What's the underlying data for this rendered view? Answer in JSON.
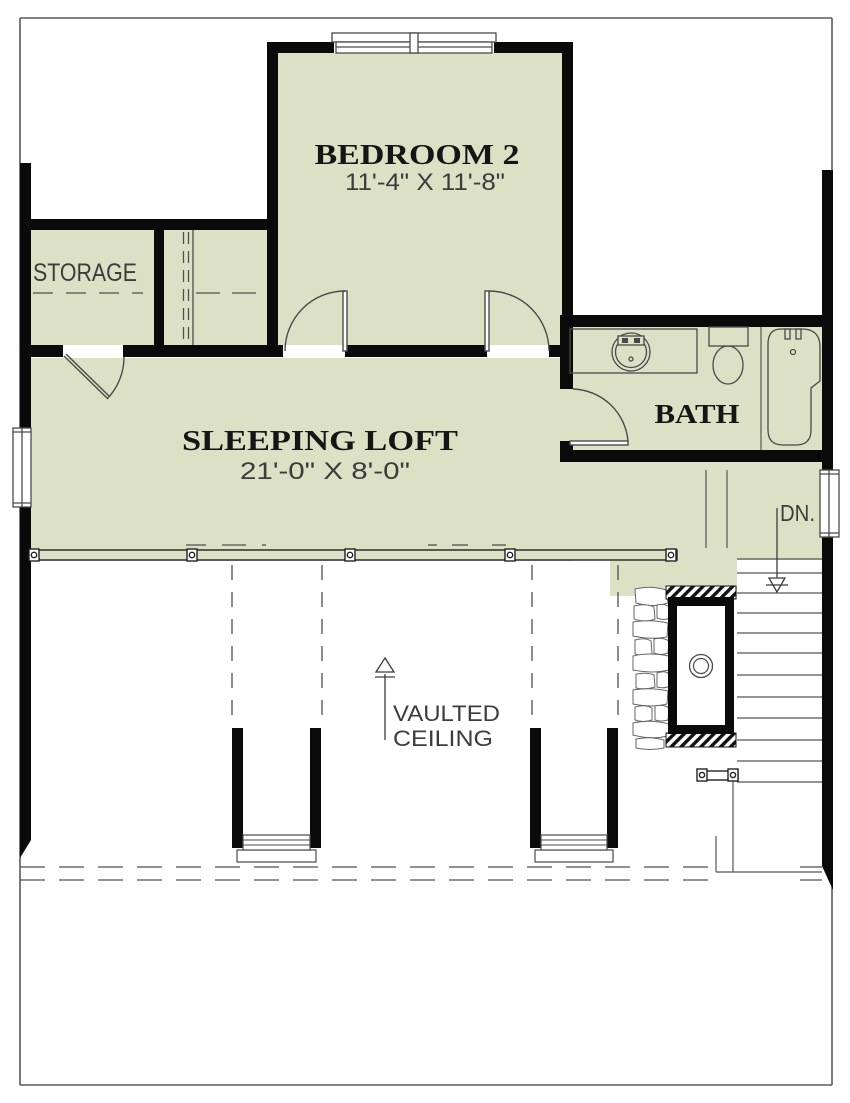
{
  "document": {
    "type": "architectural floor plan",
    "level": "loft / second floor"
  },
  "colors": {
    "floor_fill": "#dce1c6",
    "wall": "#0a0a0a",
    "thin_line": "#4a4a4a",
    "background": "#ffffff"
  },
  "rooms": {
    "bedroom2": {
      "name": "BEDROOM 2",
      "dimensions": "11'-4\" X 11'-8\""
    },
    "sleeping_loft": {
      "name": "SLEEPING LOFT",
      "dimensions": "21'-0\" X 8'-0\""
    },
    "storage": {
      "name": "STORAGE"
    },
    "bath": {
      "name": "BATH"
    }
  },
  "annotations": {
    "stairs_down": "DN.",
    "vaulted_line1": "VAULTED",
    "vaulted_line2": "CEILING"
  }
}
